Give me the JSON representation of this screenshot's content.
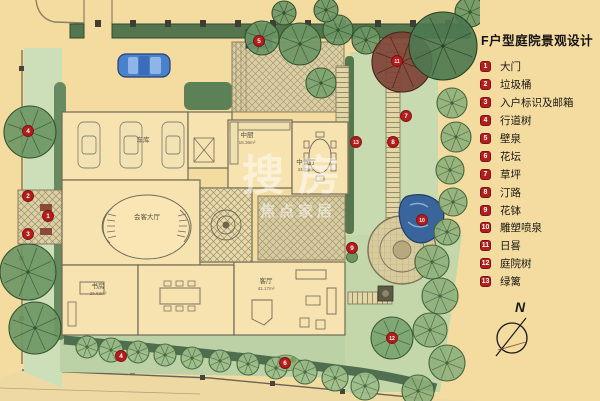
{
  "title": "F户型庭院景观设计",
  "legend": {
    "items": [
      {
        "n": "1",
        "label": "大门"
      },
      {
        "n": "2",
        "label": "垃圾桶"
      },
      {
        "n": "3",
        "label": "入户标识及邮箱"
      },
      {
        "n": "4",
        "label": "行道树"
      },
      {
        "n": "5",
        "label": "壁泉"
      },
      {
        "n": "6",
        "label": "花坛"
      },
      {
        "n": "7",
        "label": "草坪"
      },
      {
        "n": "8",
        "label": "汀路"
      },
      {
        "n": "9",
        "label": "花钵"
      },
      {
        "n": "10",
        "label": "雕塑喷泉"
      },
      {
        "n": "11",
        "label": "日晷"
      },
      {
        "n": "12",
        "label": "庭院树"
      },
      {
        "n": "13",
        "label": "绿篱"
      }
    ]
  },
  "compass": {
    "label": "N"
  },
  "watermark": {
    "line1": "搜房",
    "line2": "焦点家居"
  },
  "plan": {
    "markers": [
      {
        "n": "1",
        "x": 48,
        "y": 216
      },
      {
        "n": "2",
        "x": 28,
        "y": 196
      },
      {
        "n": "3",
        "x": 28,
        "y": 234
      },
      {
        "n": "4",
        "x": 28,
        "y": 131
      },
      {
        "n": "4",
        "x": 121,
        "y": 356
      },
      {
        "n": "5",
        "x": 259,
        "y": 41
      },
      {
        "n": "6",
        "x": 285,
        "y": 363
      },
      {
        "n": "7",
        "x": 406,
        "y": 116
      },
      {
        "n": "8",
        "x": 393,
        "y": 142
      },
      {
        "n": "9",
        "x": 352,
        "y": 248
      },
      {
        "n": "10",
        "x": 422,
        "y": 220
      },
      {
        "n": "11",
        "x": 397,
        "y": 61
      },
      {
        "n": "12",
        "x": 392,
        "y": 338
      },
      {
        "n": "13",
        "x": 356,
        "y": 142
      }
    ],
    "rooms": [
      {
        "name": "车库",
        "area": "",
        "x": 143,
        "y": 142
      },
      {
        "name": "中厨",
        "area": "18.36m²",
        "x": 247,
        "y": 137
      },
      {
        "name": "中餐厅",
        "area": "34.73m²",
        "x": 306,
        "y": 164
      },
      {
        "name": "会客大厅",
        "area": "",
        "x": 147,
        "y": 219
      },
      {
        "name": "书房",
        "area": "26.63m²",
        "x": 98,
        "y": 288
      },
      {
        "name": "客厅",
        "area": "41.17m²",
        "x": 266,
        "y": 283
      }
    ]
  },
  "colors": {
    "marker_red": "#b51d1d",
    "water_blue": "#3a659c",
    "lawn_green": "#c8dbb0",
    "hedge_green": "#50734c",
    "background_beige": "#f4dca1"
  }
}
